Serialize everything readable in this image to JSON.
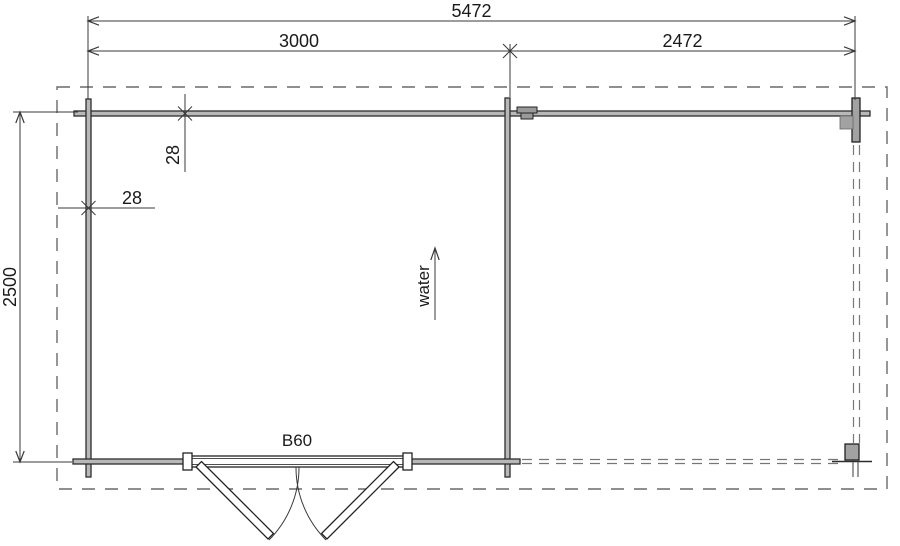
{
  "dimensions": {
    "overall_width": "5472",
    "room_width": "3000",
    "terrace_width": "2472",
    "overall_depth": "2500",
    "wall_thickness_front": "28",
    "wall_thickness_side": "28"
  },
  "annotations": {
    "water_label": "water",
    "door_label": "B60"
  },
  "colors": {
    "background": "#ffffff",
    "wall_fill": "#b8b8b8",
    "wall_stroke": "#2d2d2d",
    "line": "#3a3a3a",
    "dashed": "#6a6a6a",
    "post_fill": "#a2a2a2",
    "text": "#1a1a1a"
  }
}
